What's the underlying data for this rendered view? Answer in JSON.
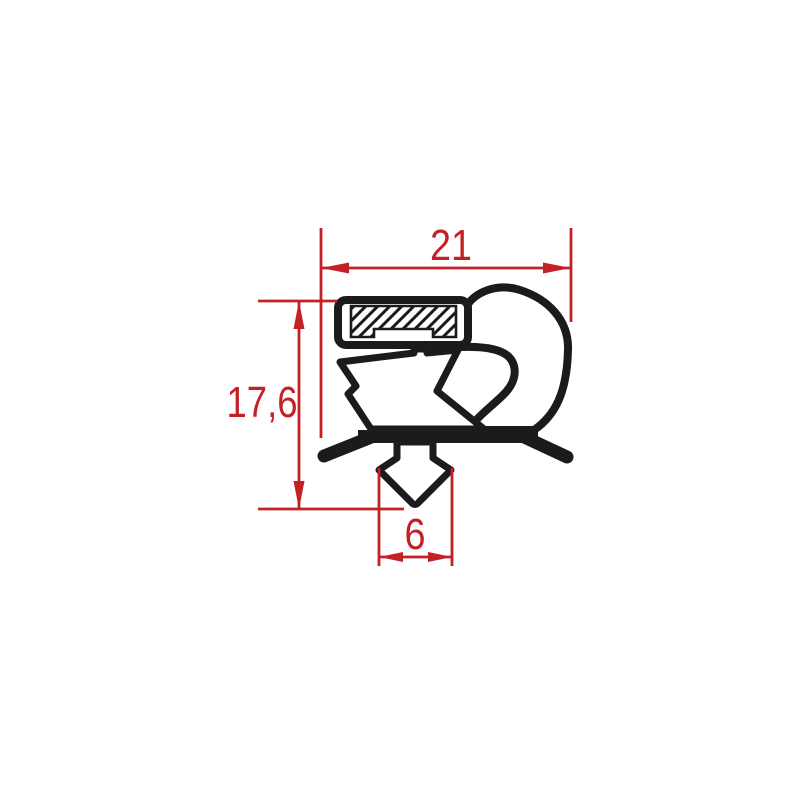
{
  "drawing": {
    "dimensions": {
      "width": "21",
      "height": "17,6",
      "dart_width": "6"
    },
    "colors": {
      "dimension_red": "#c42127",
      "profile_black": "#1b1b1b",
      "background": "#ffffff"
    },
    "parts": [
      "magnet-insert",
      "magnet-housing",
      "balloon-chamber",
      "bellows",
      "mounting-flange",
      "push-in-dart"
    ]
  }
}
